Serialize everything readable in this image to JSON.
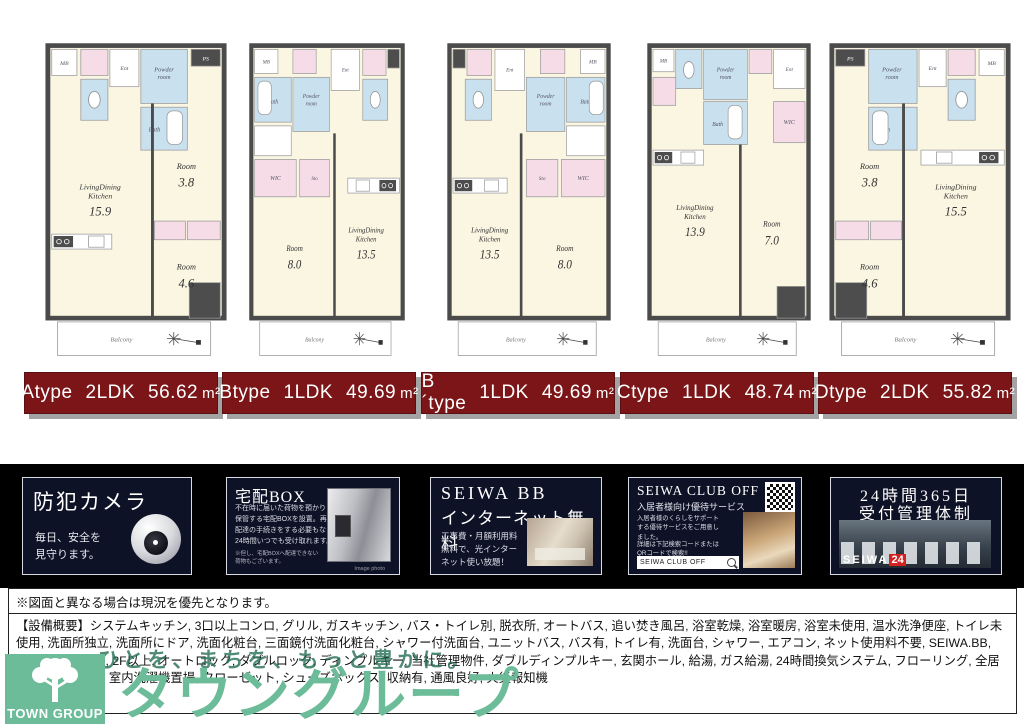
{
  "floorplan_terms": {
    "balcony": "Balcony",
    "bath": "Bath",
    "powder_room": "Powder room",
    "ent": "Ent",
    "mb": "MB",
    "ps": "PS",
    "wic": "WIC",
    "sto": "Sto"
  },
  "plans": [
    {
      "id": "A",
      "geom": "A",
      "name": "Atype",
      "plan_type": "2LDK",
      "area_value": "56.62",
      "area_unit": "m²",
      "rooms": [
        {
          "name": "LivingDining Kitchen",
          "size": "15.9"
        },
        {
          "name": "Room",
          "size": "3.8"
        },
        {
          "name": "Room",
          "size": "4.6"
        }
      ]
    },
    {
      "id": "B",
      "geom": "B",
      "name": "Btype",
      "plan_type": "1LDK",
      "area_value": "49.69",
      "area_unit": "m²",
      "rooms": [
        {
          "name": "Room",
          "size": "8.0"
        },
        {
          "name": "LivingDining Kitchen",
          "size": "13.5"
        }
      ]
    },
    {
      "id": "B´",
      "geom": "Bp",
      "name": "B´type",
      "plan_type": "1LDK",
      "area_value": "49.69",
      "area_unit": "m²",
      "rooms": [
        {
          "name": "LivingDining Kitchen",
          "size": "13.5"
        },
        {
          "name": "Room",
          "size": "8.0"
        }
      ]
    },
    {
      "id": "C",
      "geom": "C",
      "name": "Ctype",
      "plan_type": "1LDK",
      "area_value": "48.74",
      "area_unit": "m²",
      "rooms": [
        {
          "name": "LivingDining Kitchen",
          "size": "13.9"
        },
        {
          "name": "Room",
          "size": "7.0"
        }
      ]
    },
    {
      "id": "D",
      "geom": "D",
      "name": "Dtype",
      "plan_type": "2LDK",
      "area_value": "55.82",
      "area_unit": "m²",
      "rooms": [
        {
          "name": "LivingDining Kitchen",
          "size": "15.5"
        },
        {
          "name": "Room",
          "size": "3.8"
        },
        {
          "name": "Room",
          "size": "4.6"
        }
      ]
    }
  ],
  "features": [
    {
      "title": "防犯カメラ",
      "body": "毎日、安全を\n見守ります。"
    },
    {
      "title": "宅配BOX",
      "body": "不在時に届いた荷物を預かり\n保管する宅配BOXを設置。再\n配達の手続きをする必要もなく、\n24時間いつでも受け取れます。",
      "note": "※但し、宅配BOXへ配達できない\n荷物もございます。",
      "caption": "Image photo"
    },
    {
      "title": "SEIWA BB",
      "title2": "インターネット無料",
      "body": "工事費・月額利用料\n無料で、光インター\nネット使い放題！"
    },
    {
      "title": "SEIWA CLUB OFF",
      "subtitle": "入居者様向け優待サービス",
      "body": "入居者様のくらしをサポート\nする優待サービスをご用意し\nました。",
      "body2": "詳細は下記検索コードまたは\nQRコードで検索!!",
      "search": "SEIWA CLUB OFF"
    },
    {
      "title": "24時間365日",
      "title2": "受付管理体制",
      "badge": "SEIWA",
      "badge2": "24"
    }
  ],
  "footer": {
    "notice": "※図面と異なる場合は現況を優先となります。",
    "equipment": "【設備概要】システムキッチン, 3口以上コンロ, グリル, ガスキッチン, バス・トイレ別, 脱衣所, オートバス, 追い焚き風呂, 浴室乾燥, 浴室暖房, 浴室未使用, 温水洗浄便座, トイレ未使用, 洗面所独立, 洗面所にドア, 洗面化粧台, 三面鏡付洗面化粧台, シャワー付洗面台, ユニットバス, バス有, トイレ有, 洗面台, シャワー, エアコン, ネット使用料不要, SEIWA.BB, TVインターホン, 2F以上, オートロック, ダブルロック, ディンプルキー, 当社管理物件, ダブルディンプルキー, 玄関ホール, 給湯, ガス給湯, 24時間換気システム, フローリング, 全居室フローリング, 室内洗濯機置場, クローゼット, シューズボックス, 収納有, 通風良好, 火災報知機",
    "slogan": "ひとを、まちを、もっと豊かに。",
    "brand": {
      "logo_text": "TOWN GROUP",
      "brand_name": "タウングループ"
    }
  },
  "colors": {
    "label_bg": "#7b1517",
    "label_shadow": "#a3a3a3",
    "banner_bg": "#000000",
    "card_bg": "#0e1226",
    "accent_green": "#6cbc99",
    "plan_cream": "#faf6e2",
    "plan_blue": "#c9e0ee",
    "plan_pink": "#f5dce6",
    "plan_wall": "#4b4b4b"
  }
}
